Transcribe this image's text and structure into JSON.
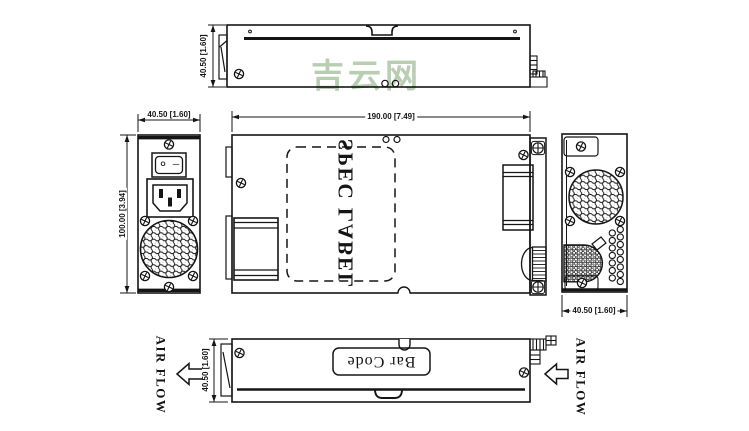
{
  "watermark": {
    "text": "吉云网",
    "color": "#b4cbae"
  },
  "drawing": {
    "line_color": "#151515",
    "top_view": {
      "dim_depth": "40.50 [1.60]"
    },
    "front_view": {
      "dim_width": "40.50 [1.60]",
      "dim_height": "100.00 [3.94]",
      "switch_off": "O",
      "switch_on": "—"
    },
    "side_view": {
      "dim_length": "190.00 [7.49]",
      "spec_label": "SPEC LABEL"
    },
    "rear_view": {
      "dim_width": "40.50 [1.60]"
    },
    "bottom_view": {
      "dim_depth": "40.50 [1.60]",
      "barcode_label": "Bar Code"
    },
    "airflow_left": "AIR FLOW",
    "airflow_right": "AIR FLOW"
  }
}
